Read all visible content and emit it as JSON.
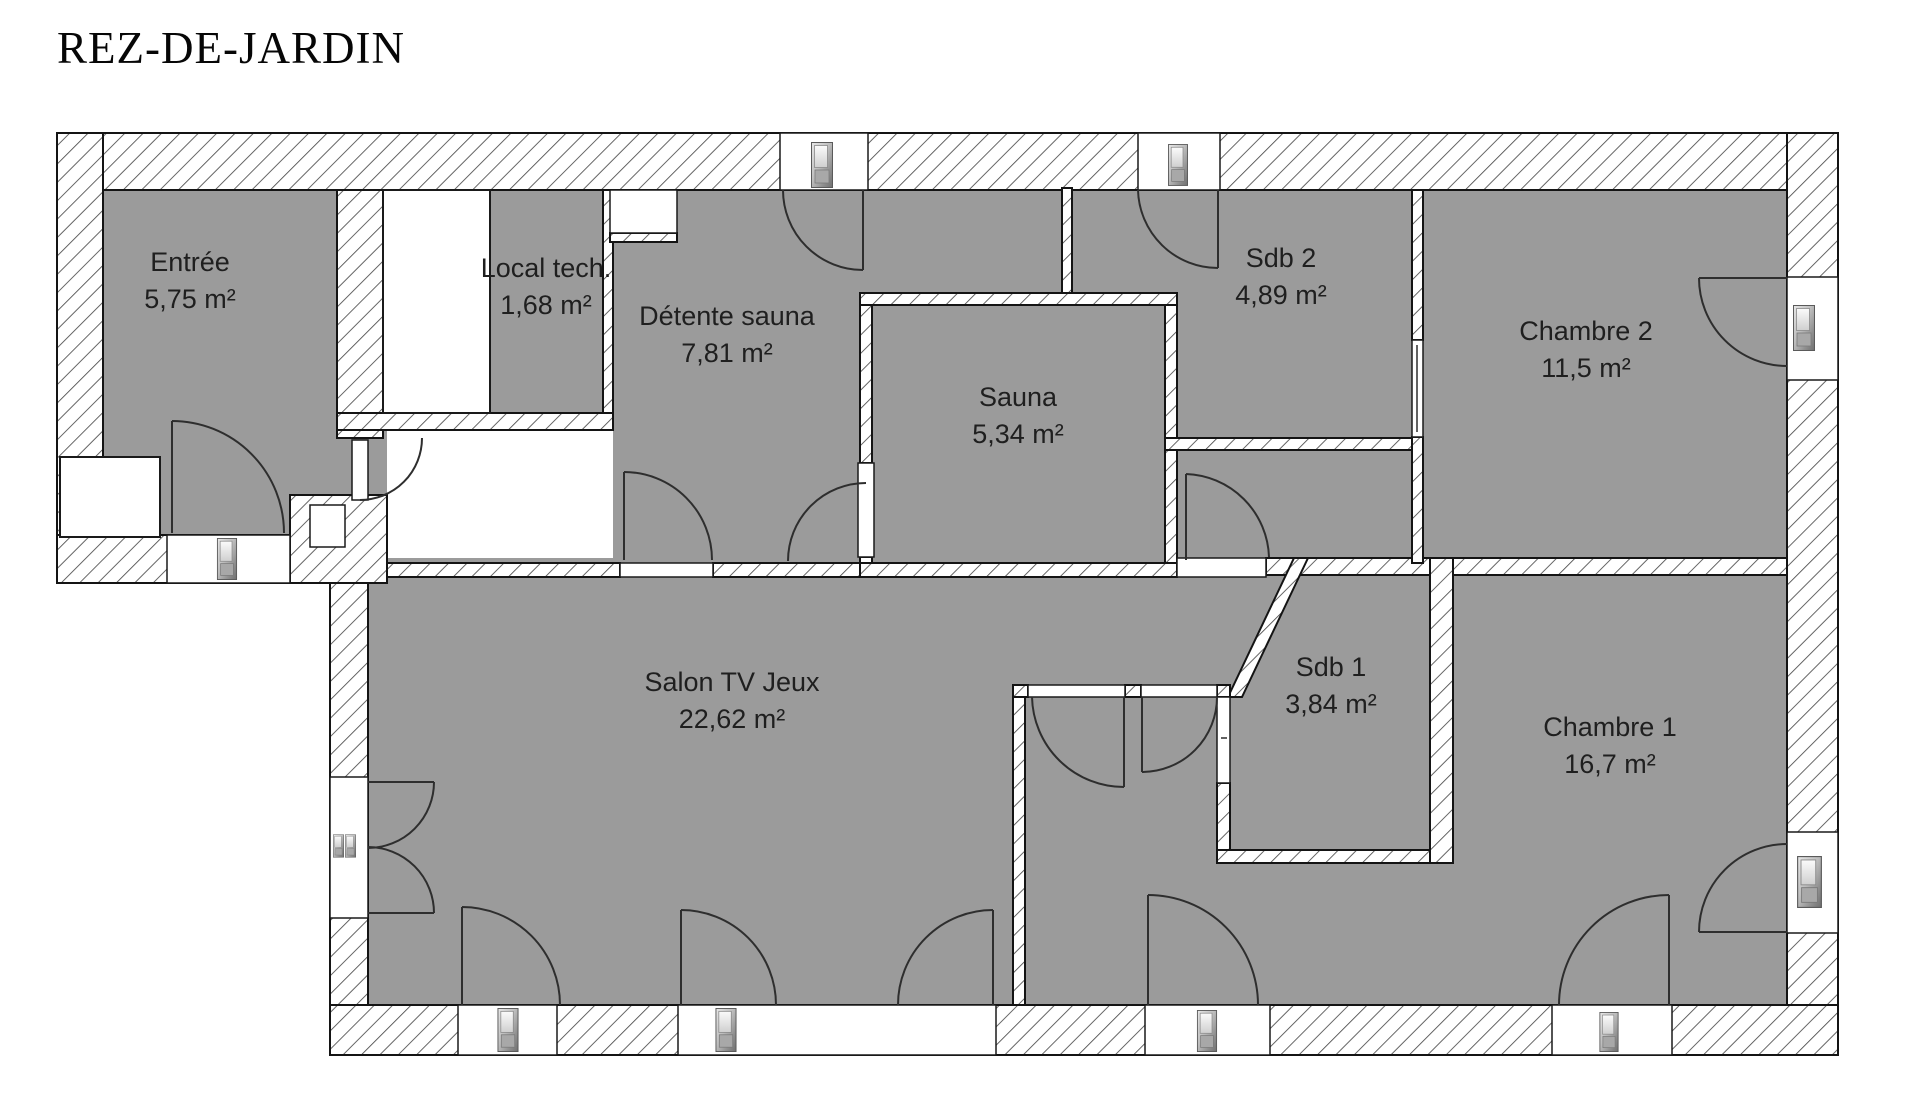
{
  "title": "REZ-DE-JARDIN",
  "floor_label": "garden level floor plan",
  "colors": {
    "floor": "#9b9b9b",
    "hatch_line": "#4a4a4a",
    "outline": "#141414",
    "arc": "#2e2e2e",
    "text": "#1f1f1f"
  },
  "rooms": [
    {
      "id": "entree",
      "name": "Entrée",
      "area": "5,75 m²",
      "x": 190,
      "y": 262
    },
    {
      "id": "local-tech",
      "name": "Local tech.",
      "area": "1,68 m²",
      "x": 546,
      "y": 268
    },
    {
      "id": "detente-sauna",
      "name": "Détente sauna",
      "area": "7,81 m²",
      "x": 727,
      "y": 316
    },
    {
      "id": "sauna",
      "name": "Sauna",
      "area": "5,34 m²",
      "x": 1018,
      "y": 397
    },
    {
      "id": "sdb2",
      "name": "Sdb 2",
      "area": "4,89 m²",
      "x": 1281,
      "y": 258
    },
    {
      "id": "chambre2",
      "name": "Chambre 2",
      "area": "11,5 m²",
      "x": 1586,
      "y": 331
    },
    {
      "id": "salon",
      "name": "Salon TV Jeux",
      "area": "22,62 m²",
      "x": 732,
      "y": 682
    },
    {
      "id": "sdb1",
      "name": "Sdb 1",
      "area": "3,84 m²",
      "x": 1331,
      "y": 667
    },
    {
      "id": "chambre1",
      "name": "Chambre 1",
      "area": "16,7 m²",
      "x": 1610,
      "y": 727
    }
  ],
  "openings": {
    "window_door_icon_count": 9,
    "french_window_icon_count": 1,
    "interior_door_count": 10
  }
}
